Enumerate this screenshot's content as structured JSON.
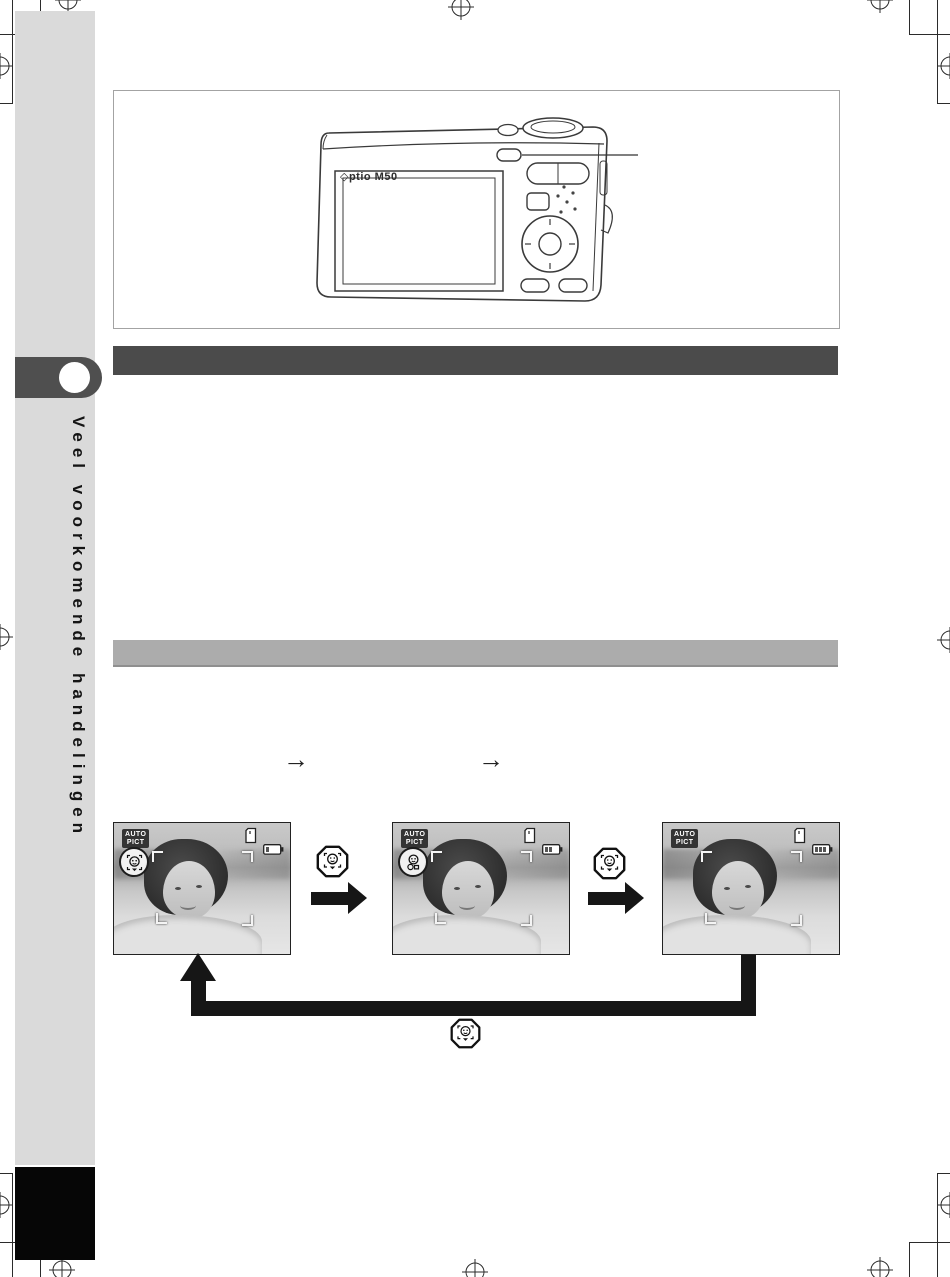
{
  "page": {
    "type": "camera-manual-page",
    "language": "nl"
  },
  "sidebar": {
    "label": "Veel voorkomende handelingen",
    "bg_color": "#dadada",
    "tab_color": "#4f4f4f",
    "footer_block_color": "#060606"
  },
  "illustration": {
    "camera_label": "◇ptio M50",
    "callout_target": "face-recognition-button"
  },
  "section_bars": [
    {
      "style": "dark",
      "color": "#4b4b4b",
      "text": ""
    },
    {
      "style": "light",
      "color": "#acacac",
      "text": ""
    }
  ],
  "flow": {
    "inline_arrows": [
      "→",
      "→"
    ],
    "screens": [
      {
        "badge": {
          "line1": "AUTO",
          "line2": "PICT"
        },
        "status_icon": "face-priority-icon",
        "hud_icons": [
          "memory-card-icon",
          "battery-icon",
          "focus-brackets"
        ]
      },
      {
        "badge": {
          "line1": "AUTO",
          "line2": "PICT"
        },
        "status_icon": "smile-capture-icon",
        "hud_icons": [
          "memory-card-icon",
          "battery-icon",
          "focus-brackets"
        ]
      },
      {
        "badge": {
          "line1": "AUTO",
          "line2": "PICT"
        },
        "status_icon": "none",
        "hud_icons": [
          "memory-card-icon",
          "battery-icon",
          "focus-brackets"
        ]
      }
    ],
    "between_icon": "face-recognition-button-icon",
    "loop_icon": "face-recognition-button-icon"
  },
  "colors": {
    "arrow": "#161616",
    "bar_dark": "#4b4b4b",
    "bar_light": "#acacac",
    "sidebar_bg": "#dadada"
  }
}
